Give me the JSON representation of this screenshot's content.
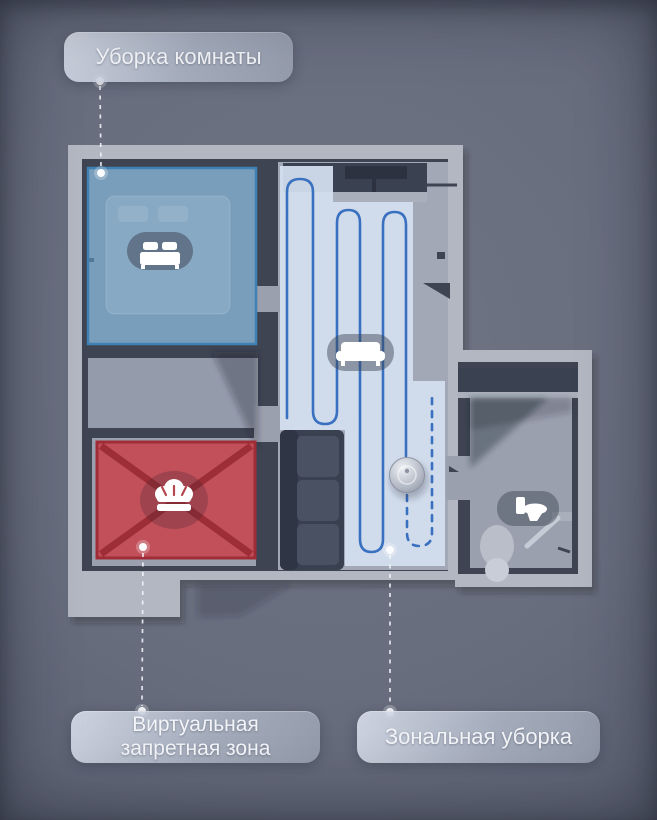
{
  "poster": {
    "labels": {
      "room_cleaning": "Уборка комнаты",
      "virtual_zone_line1": "Виртуальная",
      "virtual_zone_line2": "запретная зона",
      "zonal_cleaning": "Зональная уборка"
    },
    "zones": [
      {
        "id": "room-cleaning",
        "label": "Уборка комнаты",
        "room": "bedroom",
        "overlay_color": "#5e9cc8",
        "icon": "bed-icon"
      },
      {
        "id": "virtual-no-go-zone",
        "label": "Виртуальная запретная зона",
        "room": "kitchen",
        "overlay_color": "#c8404b",
        "icon": "chef-hat-icon"
      },
      {
        "id": "zonal-cleaning",
        "label": "Зональная уборка",
        "room": "living-room",
        "overlay_color": "#d2deee",
        "path_color": "#3a70c0",
        "icon": "sofa-icon"
      },
      {
        "id": "bathroom",
        "label": "",
        "room": "bathroom",
        "icon": "toilet-icon"
      }
    ],
    "colors": {
      "background": "#676d7d",
      "wall_face": "#b2b7c1",
      "wall_shadow": "#3e4452",
      "floor": "#9aa0ae",
      "clean_zone_fill": "#d2deee",
      "path_blue": "#3a70c0",
      "no_go_red": "#c8404b",
      "room_clean_blue": "#5e9cc8",
      "leader_line": "#f0f3f8"
    }
  }
}
